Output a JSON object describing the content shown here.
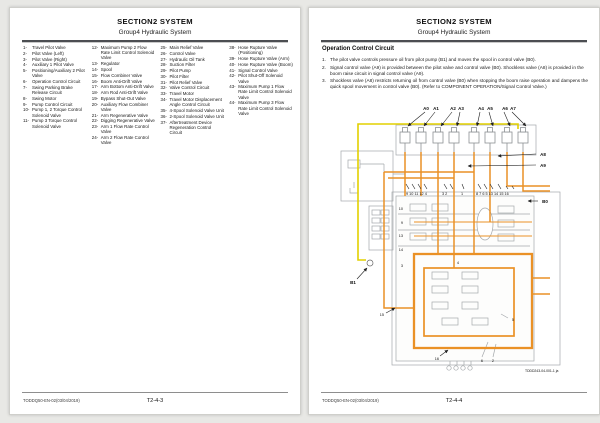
{
  "left_page": {
    "title": "SECTION2 SYSTEM",
    "subtitle": "Group4 Hydraulic System",
    "parts_col1": [
      {
        "num": "1-",
        "name": "Travel Pilot Valve"
      },
      {
        "num": "2-",
        "name": "Pilot Valve (Left)"
      },
      {
        "num": "3-",
        "name": "Pilot Valve (Right)"
      },
      {
        "num": "4-",
        "name": "Auxiliary 1 Pilot Valve"
      },
      {
        "num": "5-",
        "name": "Positioning/Auxiliary 2 Pilot Valve"
      },
      {
        "num": "6-",
        "name": "Operation Control Circuit"
      },
      {
        "num": "7-",
        "name": "Swing Parking Brake Release Circuit"
      },
      {
        "num": "8-",
        "name": "Swing Motor"
      },
      {
        "num": "9-",
        "name": "Pump Control Circuit"
      },
      {
        "num": "10-",
        "name": "Pump 1, 2 Torque Control Solenoid Valve"
      },
      {
        "num": "11-",
        "name": "Pump 3 Torque Control Solenoid Valve"
      }
    ],
    "parts_col2": [
      {
        "num": "12-",
        "name": "Maximum Pump 2 Flow Rate Limit Control Solenoid Valve"
      },
      {
        "num": "13-",
        "name": "Regulator"
      },
      {
        "num": "14-",
        "name": "Spool"
      },
      {
        "num": "15-",
        "name": "Flow Combiner Valve"
      },
      {
        "num": "16-",
        "name": "Boom Anti-Drift Valve"
      },
      {
        "num": "17-",
        "name": "Arm Bottom Anti-Drift Valve"
      },
      {
        "num": "18-",
        "name": "Arm Rod Anti-Drift Valve"
      },
      {
        "num": "19-",
        "name": "Bypass Shut-Out Valve"
      },
      {
        "num": "20-",
        "name": "Auxiliary Flow Combiner Valve"
      },
      {
        "num": "21-",
        "name": "Arm Regenerative Valve"
      },
      {
        "num": "22-",
        "name": "Digging Regenerative Valve"
      },
      {
        "num": "23-",
        "name": "Arm 1 Flow Rate Control Valve"
      },
      {
        "num": "24-",
        "name": "Arm 2 Flow Rate Control Valve"
      }
    ],
    "parts_col3": [
      {
        "num": "25-",
        "name": "Main Relief Valve"
      },
      {
        "num": "26-",
        "name": "Control Valve"
      },
      {
        "num": "27-",
        "name": "Hydraulic Oil Tank"
      },
      {
        "num": "28-",
        "name": "Suction Filter"
      },
      {
        "num": "29-",
        "name": "Pilot Pump"
      },
      {
        "num": "30-",
        "name": "Pilot Filter"
      },
      {
        "num": "31-",
        "name": "Pilot Relief Valve"
      },
      {
        "num": "32-",
        "name": "Valve Control Circuit"
      },
      {
        "num": "33-",
        "name": "Travel Motor"
      },
      {
        "num": "34-",
        "name": "Travel Motor Displacement Angle Control Circuit"
      },
      {
        "num": "35-",
        "name": "4-Spool Solenoid Valve Unit"
      },
      {
        "num": "36-",
        "name": "2-Spool Solenoid Valve Unit"
      },
      {
        "num": "37-",
        "name": "Aftertreatment Device Regeneration Control Circuit"
      }
    ],
    "parts_col4": [
      {
        "num": "38-",
        "name": "Hose Rupture Valve (Positioning)"
      },
      {
        "num": "39-",
        "name": "Hose Rupture Valve (Arm)"
      },
      {
        "num": "40-",
        "name": "Hose Rupture Valve (Boom)"
      },
      {
        "num": "41-",
        "name": "Signal Control Valve"
      },
      {
        "num": "42-",
        "name": "Pilot Shut-Off Solenoid Valve"
      },
      {
        "num": "43-",
        "name": "Maximum Pump 1 Flow Rate Limit Control Solenoid Valve"
      },
      {
        "num": "44-",
        "name": "Maximum Pump 3 Flow Rate Limit Control Solenoid Valve"
      }
    ],
    "footer_code": "TODDQ50-EN-02(03/04/2019)",
    "page_number": "T2-4-3"
  },
  "right_page": {
    "title": "SECTION2 SYSTEM",
    "subtitle": "Group4 Hydraulic System",
    "section_heading": "Operation Control Circuit",
    "steps": [
      {
        "num": "1.",
        "text": "The pilot valve controls pressure oil from pilot pump (B1) and moves the spool in control valve (B0)."
      },
      {
        "num": "2.",
        "text": "Signal control valve (A9) is provided between the pilot valve and control valve (B0). Shockless valve (A8) is provided in the boom raise circuit in signal control valve (A9)."
      },
      {
        "num": "3.",
        "text": "Shockless valve (A8) restricts returning oil from control valve (B0) when stopping the boom raise operation and dampens the quick spool movement in control valve (B0). (Refer to COMPONENT OPERATION/Signal Control Valve.)"
      }
    ],
    "diagram": {
      "top_labels": [
        "A0",
        "A1",
        "A2",
        "A3",
        "A4",
        "A5",
        "A6",
        "A7"
      ],
      "label_a8": "A8",
      "label_a9": "A9",
      "label_b0": "B0",
      "label_b1": "B1",
      "ports_left": "9 10 11 12 4",
      "ports_mid": "3 2",
      "ports_one": "1",
      "ports_right": "8 7 6 5 13 14 15 16",
      "side_numbers": [
        "10",
        "9",
        "13",
        "14",
        "3",
        "15",
        "16",
        "6",
        "2",
        "5",
        "4"
      ],
      "figure_id": "TDDD243-04-001-1 ja",
      "colors": {
        "pilot_line": "#ea9126",
        "signal_line": "#e2d000"
      }
    },
    "footer_code": "TODDQ50-EN-02(03/04/2019)",
    "page_number": "T2-4-4"
  }
}
